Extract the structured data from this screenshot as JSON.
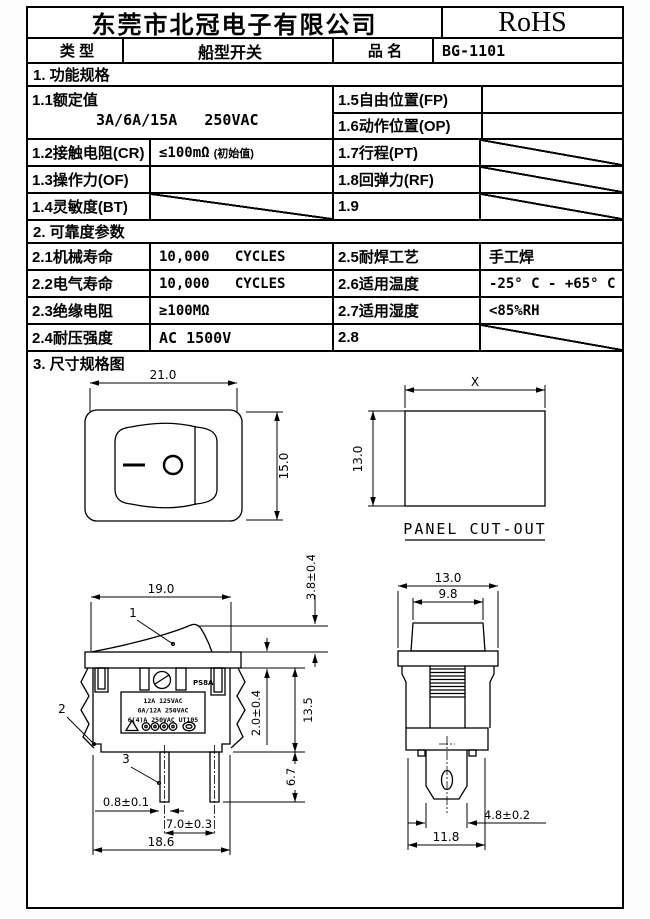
{
  "header": {
    "company": "东莞市北冠电子有限公司",
    "rohs": "RoHS"
  },
  "product": {
    "type_label": "类 型",
    "type_value": "船型开关",
    "name_label": "品 名",
    "name_value": "BG-1101"
  },
  "sections": {
    "s1": "1. 功能规格",
    "s2": "2. 可靠度参数",
    "s3": "3.  尺寸规格图"
  },
  "spec1": {
    "rated_label": "1.1额定值",
    "rated_value": "3A/6A/15A   250VAC",
    "fp_label": "1.5自由位置(FP)",
    "op_label": "1.6动作位置(OP)",
    "cr_label": "1.2接触电阻(CR)",
    "cr_value": "≤100mΩ",
    "cr_note": "(初始值)",
    "pt_label": "1.7行程(PT)",
    "of_label": "1.3操作力(OF)",
    "rf_label": "1.8回弹力(RF)",
    "bt_label": "1.4灵敏度(BT)",
    "n19_label": "1.9"
  },
  "spec2": {
    "mech_label": "2.1机械寿命",
    "mech_value": "10,000   CYCLES",
    "solder_label": "2.5耐焊工艺",
    "solder_value": "手工焊",
    "elec_label": "2.2电气寿命",
    "elec_value": "10,000   CYCLES",
    "temp_label": "2.6适用温度",
    "temp_value": "-25° C - +65° C",
    "ins_label": "2.3绝缘电阻",
    "ins_value": "≥100MΩ",
    "hum_label": "2.7适用湿度",
    "hum_value": "<85%RH",
    "volt_label": "2.4耐压强度",
    "volt_value": "AC 1500V",
    "n28_label": "2.8"
  },
  "drawings": {
    "top_view": {
      "width": "21.0",
      "height": "15.0"
    },
    "panel_cutout": {
      "width": "X",
      "height": "13.0",
      "caption": "PANEL CUT-OUT"
    },
    "side_view": {
      "top_width": "19.0",
      "rocker_height": "3.8±0.4",
      "flange_thickness": "2.0±0.4",
      "body_height": "13.5",
      "terminal_length": "6.7",
      "terminal_thickness": "0.8±0.1",
      "terminal_pitch": "7.0±0.3",
      "bottom_width": "18.6",
      "callout1": "1",
      "callout2": "2",
      "callout3": "3",
      "marking": "PS8A",
      "rating_line1": "12A 125VAC",
      "rating_line2": "6A/12A 250VAC",
      "rating_line3": "6(4)A 250VAC UT105"
    },
    "front_view": {
      "flange_width": "13.0",
      "rocker_width": "9.8",
      "terminal_width": "4.8±0.2",
      "base_width": "11.8"
    }
  }
}
